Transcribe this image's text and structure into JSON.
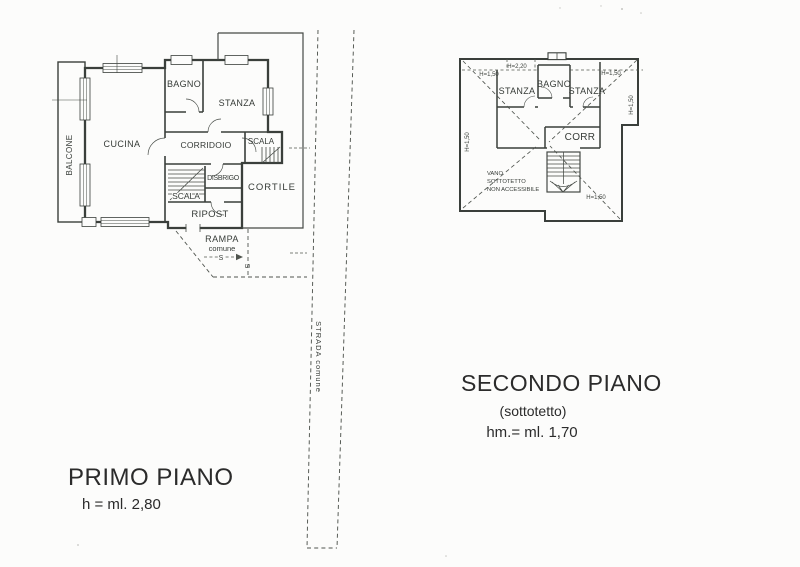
{
  "colors": {
    "ink": "#3a3f3b",
    "paper": "#fcfcfb"
  },
  "floor1": {
    "title": "PRIMO PIANO",
    "height_note": "h = ml. 2,80",
    "labels": {
      "balcone": "BALCONE",
      "cucina": "CUCINA",
      "bagno": "BAGNO",
      "stanza": "STANZA",
      "corridoio": "CORRIDOIO",
      "scala_esterna": "SCALA",
      "scala_interna": "SCALA",
      "disbrigo": "DISBRIGO",
      "ripost": "RIPOST",
      "cortile": "CORTILE",
      "rampa": "RAMPA",
      "rampa_comune": "comune",
      "s_marker": "S",
      "strada": "STRADA  comune"
    }
  },
  "floor2": {
    "title": "SECONDO PIANO",
    "subtitle": "(sottotetto)",
    "height_note": "hm.= ml. 1,70",
    "labels": {
      "stanza_sx": "STANZA",
      "bagno": "BAGNO",
      "stanza_dx": "STANZA",
      "corr": "CORR",
      "vano_1": "VANO",
      "vano_2": "SOTTOTETTO",
      "vano_3": "NON ACCESSIBILE"
    },
    "dimensions": {
      "h_150": "H=1,50",
      "h_220": "H=2,20"
    }
  }
}
